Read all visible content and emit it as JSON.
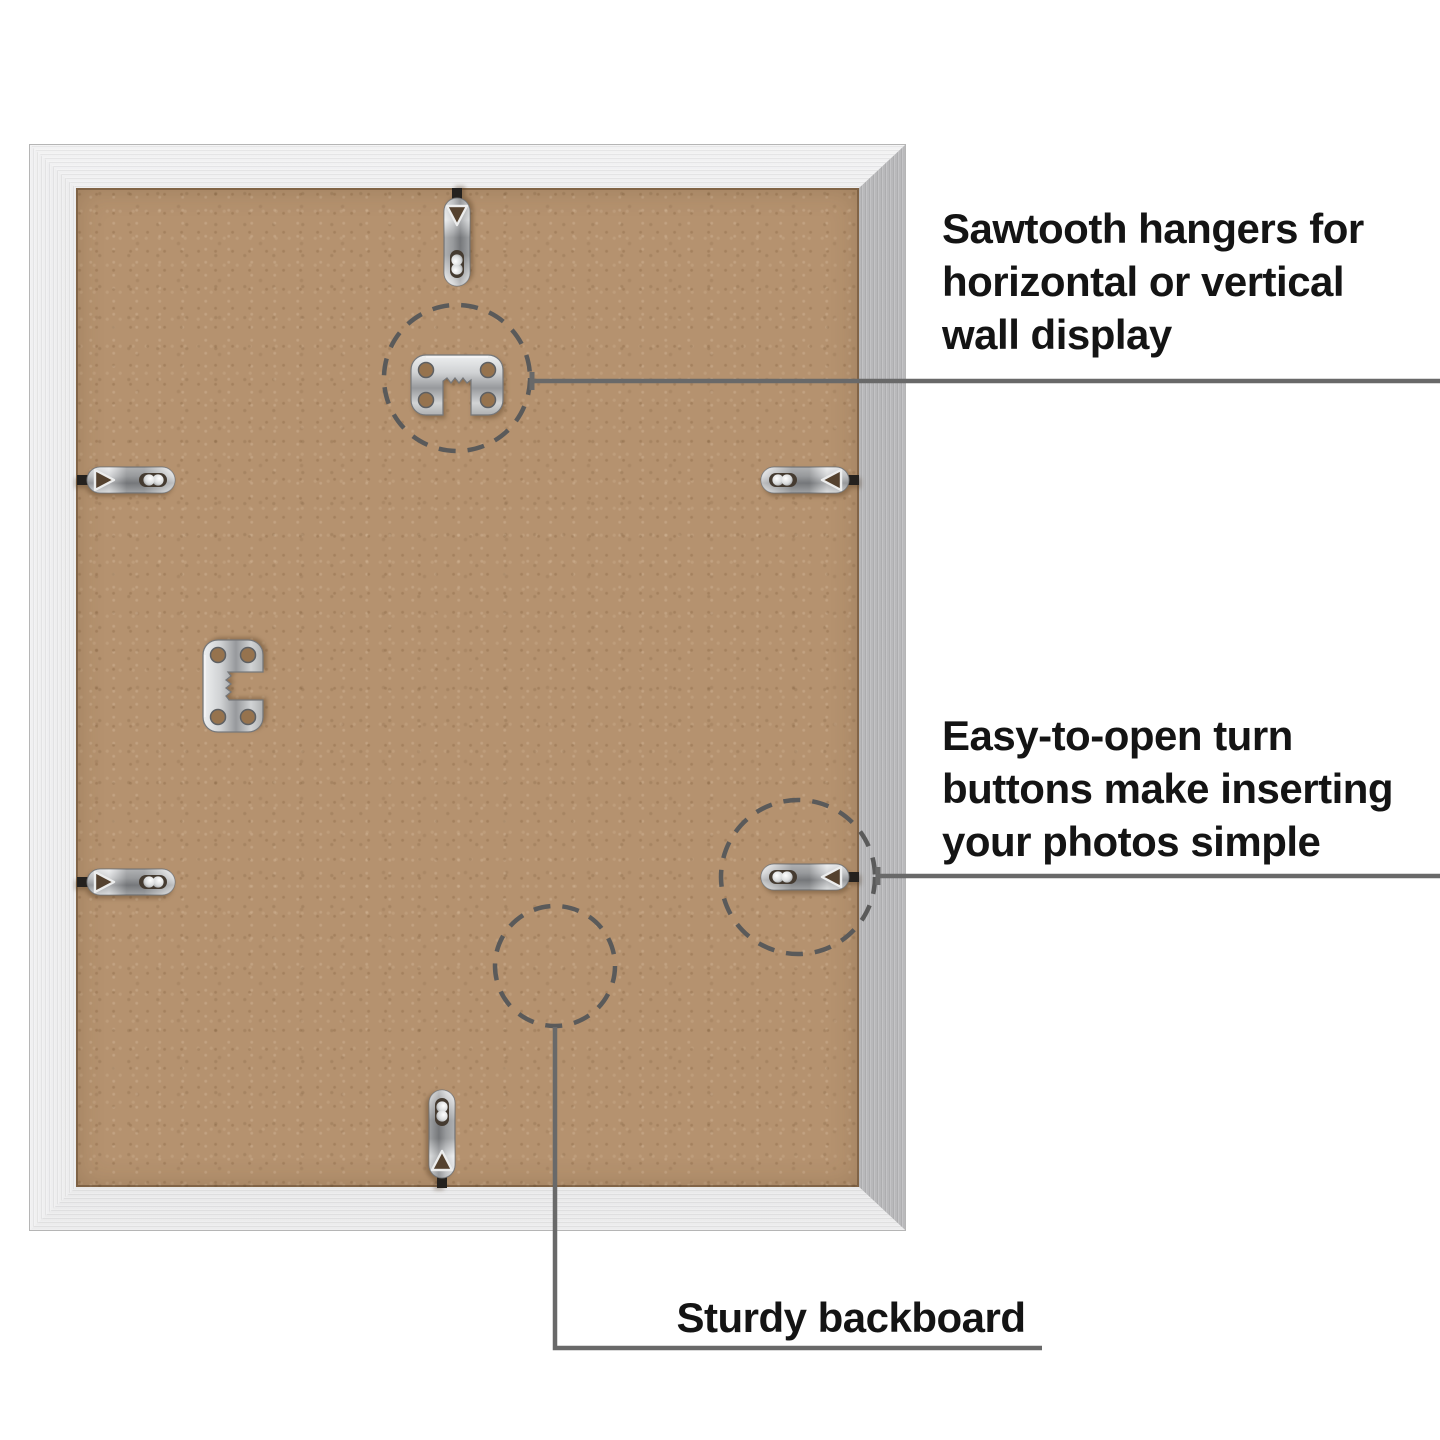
{
  "product_diagram": {
    "annotations": {
      "sawtooth": {
        "full_text": "Sawtooth hangers for horizontal or vertical wall display",
        "lines": [
          "Sawtooth hangers for",
          "horizontal or vertical",
          "wall display"
        ]
      },
      "turn_buttons": {
        "full_text": "Easy-to-open turn buttons make inserting your photos simple",
        "lines": [
          "Easy-to-open turn",
          "buttons make inserting",
          "your photos simple"
        ]
      },
      "backboard": {
        "full_text": "Sturdy backboard",
        "lines": [
          "Sturdy backboard"
        ]
      }
    },
    "hardware": {
      "sawtooth_hanger_count": 2,
      "turn_button_count": 6,
      "highlight_circle_count": 3
    },
    "icons": [
      "sawtooth-hanger-icon",
      "turn-button-icon",
      "dashed-highlight-circle",
      "callout-line"
    ],
    "colors": {
      "background": "#ffffff",
      "text": "#141414",
      "callout_line": "#696969",
      "dashed_circle": "#5a5a5a",
      "backboard_tan": "#b5926f",
      "frame_silver_light": "#f0f0f1",
      "frame_silver_dark": "#aaaaac",
      "metal_hardware": "#c9cbcd"
    }
  }
}
